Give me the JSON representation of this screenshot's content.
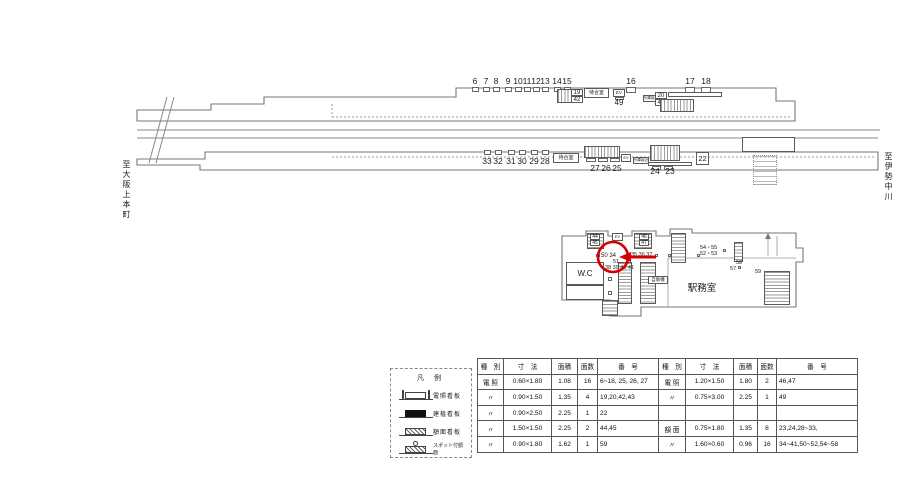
{
  "colors": {
    "highlight_red": "#d40000",
    "line": "#777777"
  },
  "direction_labels": {
    "left": "至大阪上本町",
    "right": "至伊勢中川"
  },
  "legend": {
    "title": "凡 例",
    "items": [
      {
        "label": "電照看板",
        "icon": "lit"
      },
      {
        "label": "建植看板",
        "icon": "solid"
      },
      {
        "label": "額面看板",
        "icon": "hatch"
      },
      {
        "label": "スポット付額面",
        "icon": "spot"
      }
    ]
  },
  "table": {
    "headers": [
      "種　別",
      "寸　法",
      "面積",
      "面数",
      "番　号"
    ],
    "left_col_widths": [
      21,
      43,
      21,
      15,
      56
    ],
    "right_col_widths": [
      22,
      43,
      19,
      14,
      76
    ],
    "left_rows": [
      [
        "電 照",
        "0.60×1.80",
        "1.08",
        "16",
        "6~18, 25, 26, 27"
      ],
      [
        "〃",
        "0.90×1.50",
        "1.35",
        "4",
        "19,20,42,43"
      ],
      [
        "〃",
        "0.90×2.50",
        "2.25",
        "1",
        "22"
      ],
      [
        "〃",
        "1.50×1.50",
        "2.25",
        "2",
        "44,45"
      ],
      [
        "〃",
        "0.90×1.80",
        "1.62",
        "1",
        "59"
      ]
    ],
    "right_rows": [
      [
        "電 照",
        "1.20×1.50",
        "1.80",
        "2",
        "46,47"
      ],
      [
        "〃",
        "0.75×3.00",
        "2.25",
        "1",
        "49"
      ],
      [
        "",
        "",
        "",
        "",
        ""
      ],
      [
        "額 面",
        "0.75×1.80",
        "1.35",
        "8",
        "23,24,28~33,"
      ],
      [
        "〃",
        "1.60×0.60",
        "0.96",
        "16",
        "34~41,50~52,54~58"
      ]
    ]
  },
  "diagram": {
    "labels": [
      {
        "name": "direction-left",
        "text": "至大阪上本町",
        "x": 122,
        "y": 160,
        "fs": 8,
        "cls": "vert"
      },
      {
        "name": "direction-right",
        "text": "至伊勢中川",
        "x": 884,
        "y": 152,
        "fs": 8,
        "cls": "vert"
      },
      {
        "name": "sign-6",
        "text": "6",
        "x": 475,
        "y": 77,
        "fs": 8.5,
        "cls": "center"
      },
      {
        "name": "sign-7",
        "text": "7",
        "x": 486,
        "y": 77,
        "fs": 8.5,
        "cls": "center"
      },
      {
        "name": "sign-8",
        "text": "8",
        "x": 496,
        "y": 77,
        "fs": 8.5,
        "cls": "center"
      },
      {
        "name": "sign-9",
        "text": "9",
        "x": 508,
        "y": 77,
        "fs": 8.5,
        "cls": "center"
      },
      {
        "name": "sign-10",
        "text": "10",
        "x": 518,
        "y": 77,
        "fs": 8.5,
        "cls": "center"
      },
      {
        "name": "sign-11",
        "text": "11",
        "x": 527,
        "y": 77,
        "fs": 8.5,
        "cls": "center"
      },
      {
        "name": "sign-12",
        "text": "12",
        "x": 536,
        "y": 77,
        "fs": 8.5,
        "cls": "center"
      },
      {
        "name": "sign-13",
        "text": "13",
        "x": 545,
        "y": 77,
        "fs": 8.5,
        "cls": "center"
      },
      {
        "name": "sign-14",
        "text": "14",
        "x": 557,
        "y": 77,
        "fs": 8.5,
        "cls": "center"
      },
      {
        "name": "sign-15",
        "text": "15",
        "x": 567,
        "y": 77,
        "fs": 8.5,
        "cls": "center"
      },
      {
        "name": "sign-16",
        "text": "16",
        "x": 631,
        "y": 77,
        "fs": 8.5,
        "cls": "center"
      },
      {
        "name": "sign-17",
        "text": "17",
        "x": 690,
        "y": 77,
        "fs": 8.5,
        "cls": "center"
      },
      {
        "name": "sign-18",
        "text": "18",
        "x": 706,
        "y": 77,
        "fs": 8.5,
        "cls": "center"
      },
      {
        "name": "sign-49",
        "text": "49",
        "x": 619,
        "y": 99,
        "fs": 8,
        "cls": "center"
      },
      {
        "name": "sign-33",
        "text": "33",
        "x": 487,
        "y": 157,
        "fs": 8.5,
        "cls": "center"
      },
      {
        "name": "sign-32",
        "text": "32",
        "x": 498,
        "y": 157,
        "fs": 8.5,
        "cls": "center"
      },
      {
        "name": "sign-31",
        "text": "31",
        "x": 511,
        "y": 157,
        "fs": 8.5,
        "cls": "center"
      },
      {
        "name": "sign-30",
        "text": "30",
        "x": 522,
        "y": 157,
        "fs": 8.5,
        "cls": "center"
      },
      {
        "name": "sign-29",
        "text": "29",
        "x": 534,
        "y": 157,
        "fs": 8.5,
        "cls": "center"
      },
      {
        "name": "sign-28",
        "text": "28",
        "x": 545,
        "y": 157,
        "fs": 8.5,
        "cls": "center"
      },
      {
        "name": "sign-27",
        "text": "27",
        "x": 595,
        "y": 164,
        "fs": 8.5,
        "cls": "center"
      },
      {
        "name": "sign-26",
        "text": "26",
        "x": 606,
        "y": 164,
        "fs": 8.5,
        "cls": "center"
      },
      {
        "name": "sign-25",
        "text": "25",
        "x": 617,
        "y": 164,
        "fs": 8.5,
        "cls": "center"
      },
      {
        "name": "sign-24",
        "text": "24",
        "x": 655,
        "y": 167,
        "fs": 8.5,
        "cls": "center"
      },
      {
        "name": "sign-23",
        "text": "23",
        "x": 670,
        "y": 167,
        "fs": 8.5,
        "cls": "center"
      },
      {
        "name": "sign-50-34",
        "text": "50 34",
        "x": 601,
        "y": 253,
        "fs": 6
      },
      {
        "name": "sign-35-36-37",
        "text": "35 36 37",
        "x": 631,
        "y": 253,
        "fs": 5.5
      },
      {
        "name": "sign-51",
        "text": "51",
        "x": 613,
        "y": 260,
        "fs": 5.5
      },
      {
        "name": "sign-38-39-40-41",
        "text": "38 39 40 41",
        "x": 605,
        "y": 266,
        "fs": 5.5
      },
      {
        "name": "sign-54-55",
        "text": "54 ▫ 55",
        "x": 700,
        "y": 246,
        "fs": 5.5
      },
      {
        "name": "sign-52-53",
        "text": "52 ▫ 53",
        "x": 700,
        "y": 252,
        "fs": 5.5
      },
      {
        "name": "sign-58",
        "text": "58",
        "x": 736,
        "y": 261,
        "fs": 5.5
      },
      {
        "name": "sign-57",
        "text": "57",
        "x": 730,
        "y": 267,
        "fs": 5.5
      },
      {
        "name": "sign-59",
        "text": "59",
        "x": 755,
        "y": 270,
        "fs": 5.5
      },
      {
        "name": "station-office-label",
        "text": "駅務室",
        "x": 702,
        "y": 284,
        "fs": 9.5,
        "cls": "center"
      }
    ],
    "boxes": [
      {
        "name": "sign-box-6",
        "x": 472,
        "y": 87,
        "w": 7,
        "h": 5,
        "cls": "tick"
      },
      {
        "name": "sign-box-7",
        "x": 483,
        "y": 87,
        "w": 7,
        "h": 5,
        "cls": "tick"
      },
      {
        "name": "sign-box-8",
        "x": 493,
        "y": 87,
        "w": 7,
        "h": 5,
        "cls": "tick"
      },
      {
        "name": "sign-box-9",
        "x": 505,
        "y": 87,
        "w": 7,
        "h": 5,
        "cls": "tick"
      },
      {
        "name": "sign-box-10",
        "x": 515,
        "y": 87,
        "w": 7,
        "h": 5,
        "cls": "tick"
      },
      {
        "name": "sign-box-11",
        "x": 524,
        "y": 87,
        "w": 7,
        "h": 5,
        "cls": "tick"
      },
      {
        "name": "sign-box-12",
        "x": 533,
        "y": 87,
        "w": 7,
        "h": 5,
        "cls": "tick"
      },
      {
        "name": "sign-box-13",
        "x": 542,
        "y": 87,
        "w": 7,
        "h": 5,
        "cls": "tick"
      },
      {
        "name": "sign-box-14",
        "x": 554,
        "y": 87,
        "w": 7,
        "h": 5,
        "cls": "tick"
      },
      {
        "name": "sign-box-15",
        "x": 564,
        "y": 87,
        "w": 7,
        "h": 5,
        "cls": "tick"
      },
      {
        "name": "sign-box-16",
        "x": 626,
        "y": 87,
        "w": 10,
        "h": 6,
        "cls": "tick"
      },
      {
        "name": "sign-box-17",
        "x": 685,
        "y": 87,
        "w": 10,
        "h": 6,
        "cls": "tick"
      },
      {
        "name": "sign-box-18",
        "x": 701,
        "y": 87,
        "w": 10,
        "h": 6,
        "cls": "tick"
      },
      {
        "name": "stairs-top-1",
        "x": 557,
        "y": 89,
        "w": 25,
        "h": 14,
        "cls": "hatchv"
      },
      {
        "name": "sign-label-19",
        "x": 571,
        "y": 89,
        "w": 12,
        "h": 7,
        "text": "19",
        "fs": 6
      },
      {
        "name": "sign-label-42",
        "x": 571,
        "y": 96,
        "w": 12,
        "h": 7,
        "text": "42",
        "fs": 6
      },
      {
        "name": "waiting-room-top",
        "x": 584,
        "y": 88,
        "w": 25,
        "h": 10,
        "text": "待合室",
        "fs": 5
      },
      {
        "name": "elevator-top",
        "x": 613,
        "y": 89,
        "w": 12,
        "h": 8,
        "text": "EV",
        "fs": 4.5
      },
      {
        "name": "sign-box-49",
        "x": 615,
        "y": 97,
        "w": 9,
        "h": 3,
        "cls": "tick"
      },
      {
        "name": "train-approach-top",
        "x": 643,
        "y": 95,
        "w": 16,
        "h": 7,
        "text": "列車接近",
        "fs": 3.5
      },
      {
        "name": "sign-label-20",
        "x": 655,
        "y": 92,
        "w": 12,
        "h": 7,
        "text": "20",
        "fs": 6
      },
      {
        "name": "sign-label-43",
        "x": 655,
        "y": 99,
        "w": 12,
        "h": 7,
        "text": "43",
        "fs": 6
      },
      {
        "name": "kiosk-top",
        "x": 668,
        "y": 92,
        "w": 54,
        "h": 5,
        "cls": "thin"
      },
      {
        "name": "stairs-top-2",
        "x": 660,
        "y": 99,
        "w": 34,
        "h": 13,
        "cls": "hatchv"
      },
      {
        "name": "sign-box-33",
        "x": 484,
        "y": 150,
        "w": 7,
        "h": 5,
        "cls": "tick"
      },
      {
        "name": "sign-box-32",
        "x": 495,
        "y": 150,
        "w": 7,
        "h": 5,
        "cls": "tick"
      },
      {
        "name": "sign-box-31",
        "x": 508,
        "y": 150,
        "w": 7,
        "h": 5,
        "cls": "tick"
      },
      {
        "name": "sign-box-30",
        "x": 519,
        "y": 150,
        "w": 7,
        "h": 5,
        "cls": "tick"
      },
      {
        "name": "sign-box-29",
        "x": 531,
        "y": 150,
        "w": 7,
        "h": 5,
        "cls": "tick"
      },
      {
        "name": "sign-box-28",
        "x": 542,
        "y": 150,
        "w": 7,
        "h": 5,
        "cls": "tick"
      },
      {
        "name": "waiting-room-bottom",
        "x": 553,
        "y": 153,
        "w": 26,
        "h": 10,
        "text": "待合室",
        "fs": 5
      },
      {
        "name": "stairs-bottom-1",
        "x": 584,
        "y": 146,
        "w": 36,
        "h": 12,
        "cls": "hatchv"
      },
      {
        "name": "sign-box-27",
        "x": 586,
        "y": 158,
        "w": 10,
        "h": 4,
        "cls": "tick"
      },
      {
        "name": "sign-box-26",
        "x": 598,
        "y": 158,
        "w": 10,
        "h": 4,
        "cls": "tick"
      },
      {
        "name": "sign-box-25",
        "x": 610,
        "y": 158,
        "w": 10,
        "h": 4,
        "cls": "tick"
      },
      {
        "name": "elevator-bottom",
        "x": 621,
        "y": 154,
        "w": 10,
        "h": 8,
        "text": "EV",
        "fs": 4
      },
      {
        "name": "train-approach-bottom",
        "x": 633,
        "y": 157,
        "w": 16,
        "h": 7,
        "text": "列車接近",
        "fs": 3.5
      },
      {
        "name": "stairs-bottom-2",
        "x": 650,
        "y": 145,
        "w": 30,
        "h": 16,
        "cls": "hatchv"
      },
      {
        "name": "bench-bottom",
        "x": 648,
        "y": 162,
        "w": 44,
        "h": 4,
        "cls": "thin"
      },
      {
        "name": "sign-box-24",
        "x": 652,
        "y": 166,
        "w": 9,
        "h": 4,
        "cls": "tick"
      },
      {
        "name": "sign-box-23",
        "x": 664,
        "y": 166,
        "w": 9,
        "h": 4,
        "cls": "tick"
      },
      {
        "name": "sign-22",
        "x": 696,
        "y": 152,
        "w": 13,
        "h": 13,
        "text": "22",
        "fs": 7.5
      },
      {
        "name": "structure-right",
        "x": 742,
        "y": 137,
        "w": 53,
        "h": 15,
        "cls": "thin"
      },
      {
        "name": "stairs-under",
        "x": 753,
        "y": 155,
        "w": 24,
        "h": 30,
        "cls": "dot"
      },
      {
        "name": "stairs-concourse-1",
        "x": 587,
        "y": 233,
        "w": 17,
        "h": 16,
        "cls": "hatchh"
      },
      {
        "name": "sign-label-44",
        "x": 590,
        "y": 234,
        "w": 10,
        "h": 6,
        "text": "44",
        "fs": 5
      },
      {
        "name": "sign-label-45",
        "x": 590,
        "y": 240,
        "w": 10,
        "h": 6,
        "text": "45",
        "fs": 5
      },
      {
        "name": "elevator-concourse",
        "x": 612,
        "y": 233,
        "w": 11,
        "h": 8,
        "text": "EV",
        "fs": 4
      },
      {
        "name": "stairs-concourse-2",
        "x": 634,
        "y": 233,
        "w": 18,
        "h": 16,
        "cls": "hatchh"
      },
      {
        "name": "sign-label-46",
        "x": 639,
        "y": 234,
        "w": 10,
        "h": 6,
        "text": "46",
        "fs": 5
      },
      {
        "name": "sign-label-47",
        "x": 639,
        "y": 240,
        "w": 10,
        "h": 6,
        "text": "47",
        "fs": 5
      },
      {
        "name": "stairs-concourse-3",
        "x": 671,
        "y": 233,
        "w": 15,
        "h": 30,
        "cls": "hatchh"
      },
      {
        "name": "stairs-concourse-4",
        "x": 618,
        "y": 262,
        "w": 14,
        "h": 42,
        "cls": "hatchh"
      },
      {
        "name": "stairs-concourse-5",
        "x": 640,
        "y": 262,
        "w": 16,
        "h": 42,
        "cls": "hatchh"
      },
      {
        "name": "vending-machine",
        "x": 648,
        "y": 276,
        "w": 20,
        "h": 8,
        "text": "自販機",
        "fs": 4.5
      },
      {
        "name": "wc-room",
        "x": 566,
        "y": 262,
        "w": 38,
        "h": 23,
        "text": "W.C",
        "fs": 8
      },
      {
        "name": "room-below-wc",
        "x": 566,
        "y": 285,
        "w": 38,
        "h": 15,
        "cls": "thin"
      },
      {
        "name": "stairs-concourse-6",
        "x": 602,
        "y": 300,
        "w": 16,
        "h": 16,
        "cls": "hatchh"
      },
      {
        "name": "column-hatch",
        "x": 734,
        "y": 242,
        "w": 9,
        "h": 20,
        "cls": "hatchh"
      },
      {
        "name": "escalator",
        "x": 764,
        "y": 271,
        "w": 26,
        "h": 34,
        "cls": "hatchh"
      },
      {
        "name": "column-a",
        "x": 655,
        "y": 254,
        "w": 3,
        "h": 3,
        "cls": "tick"
      },
      {
        "name": "column-b",
        "x": 668,
        "y": 254,
        "w": 3,
        "h": 3,
        "cls": "tick"
      },
      {
        "name": "column-c",
        "x": 697,
        "y": 254,
        "w": 3,
        "h": 3,
        "cls": "tick"
      },
      {
        "name": "column-d",
        "x": 723,
        "y": 249,
        "w": 3,
        "h": 3,
        "cls": "tick"
      },
      {
        "name": "column-e",
        "x": 738,
        "y": 266,
        "w": 3,
        "h": 3,
        "cls": "tick"
      },
      {
        "name": "column-f",
        "x": 608,
        "y": 277,
        "w": 4,
        "h": 4,
        "cls": "tick"
      },
      {
        "name": "column-g",
        "x": 608,
        "y": 291,
        "w": 4,
        "h": 4,
        "cls": "tick"
      },
      {
        "name": "sign-icon-50",
        "x": 596,
        "y": 254,
        "w": 4,
        "h": 3,
        "cls": "tick"
      }
    ]
  }
}
